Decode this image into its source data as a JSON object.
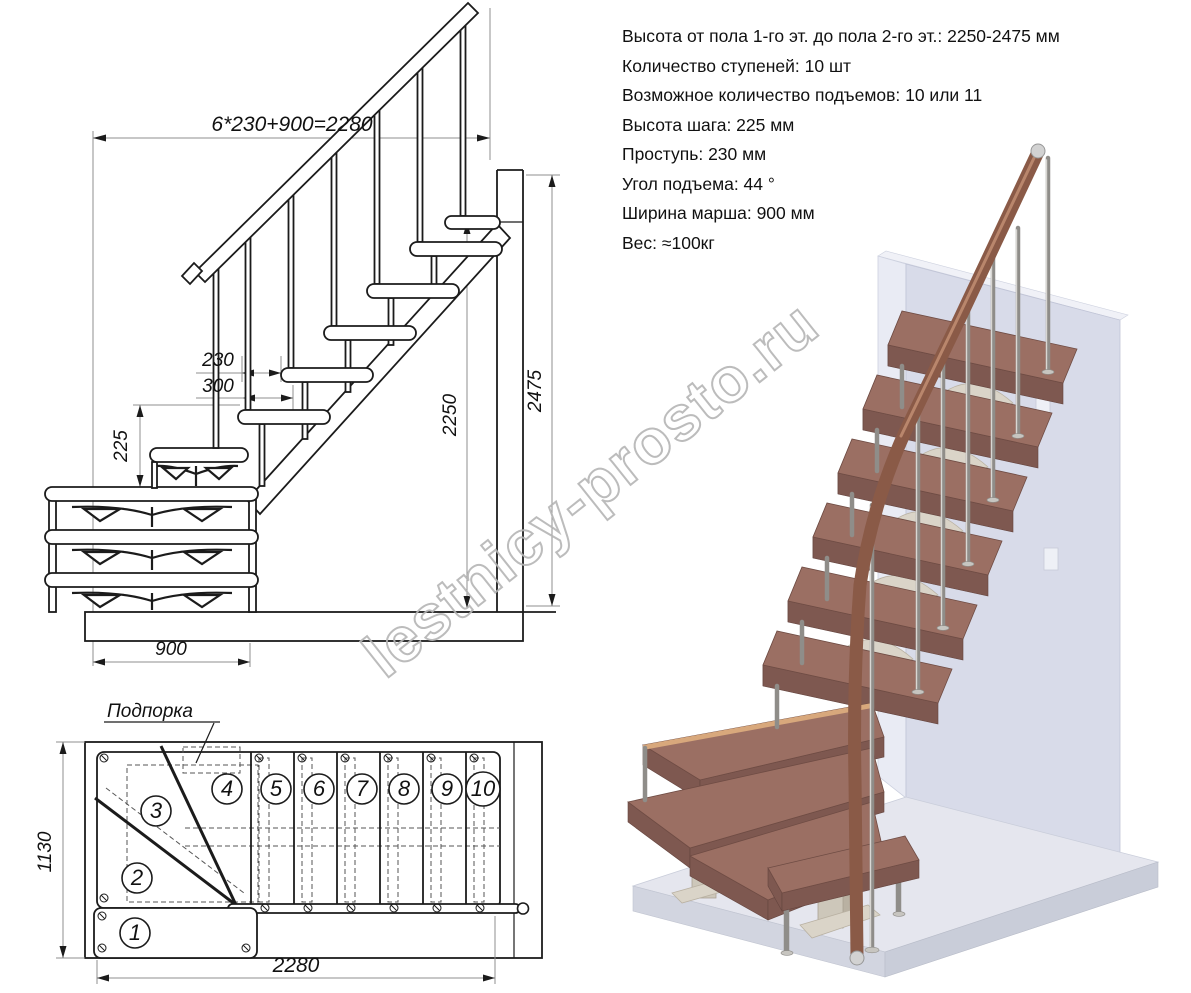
{
  "watermark": {
    "text": "lestnicy-prosto.ru"
  },
  "specs": {
    "lines": [
      "Высота от пола 1-го эт. до пола 2-го эт.: 2250-2475 мм",
      "Количество ступеней: 10 шт",
      "Возможное количество подъемов: 10 или 11",
      "Высота шага: 225 мм",
      "Проступь: 230 мм",
      "Угол подъема: 44 °",
      "Ширина марша: 900 мм",
      "Вес: ≈100кг"
    ]
  },
  "elevation_view": {
    "dim_total_run": "6*230+900=2280",
    "dim_tread_depth": "230",
    "dim_step_overlap": "300",
    "dim_riser_height": "225",
    "dim_floor_height": "2250",
    "dim_total_height": "2475",
    "dim_march_width": "900"
  },
  "plan_view": {
    "support_label": "Подпорка",
    "dim_depth": "1130",
    "dim_length": "2280",
    "step_numbers": [
      "1",
      "2",
      "3",
      "4",
      "5",
      "6",
      "7",
      "8",
      "9",
      "10"
    ]
  },
  "colors": {
    "drawing_line": "#1b1b1b",
    "dimension_line": "#8f8f8f",
    "wall_front": "#d8dbe9",
    "floor_top": "#e5e6ee",
    "tread_wood": "#9b6f63",
    "handrail_wood": "#8a5a47",
    "metal_pole": "#8f8d89",
    "bracket_cream": "#dad4c8",
    "watermark_gray": "#b5b5b5"
  }
}
